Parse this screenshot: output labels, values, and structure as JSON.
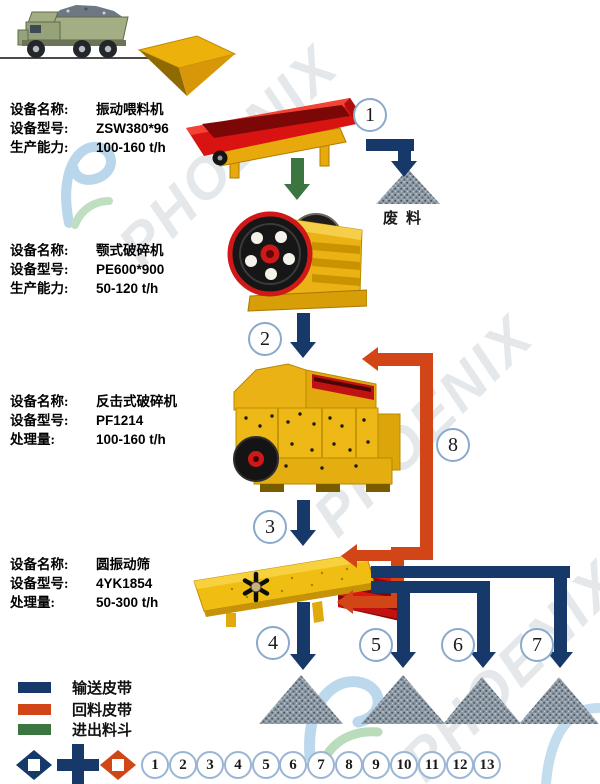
{
  "watermark": {
    "brand": "PHOENIX"
  },
  "colors": {
    "conveyor_navy": "#16396a",
    "return_red": "#d24517",
    "feed_green": "#3b7540",
    "machine_yellow": "#efb614",
    "badge_border": "#8aa9cc"
  },
  "equipment": [
    {
      "name_label": "设备名称:",
      "name": "振动喂料机",
      "model_label": "设备型号:",
      "model": "ZSW380*96",
      "capacity_label": "生产能力:",
      "capacity": "100-160 t/h"
    },
    {
      "name_label": "设备名称:",
      "name": "颚式破碎机",
      "model_label": "设备型号:",
      "model": "PE600*900",
      "capacity_label": "生产能力:",
      "capacity": "50-120 t/h"
    },
    {
      "name_label": "设备名称:",
      "name": "反击式破碎机",
      "model_label": "设备型号:",
      "model": "PF1214",
      "capacity_label": "处理量:",
      "capacity": "100-160 t/h"
    },
    {
      "name_label": "设备名称:",
      "name": "圆振动筛",
      "model_label": "设备型号:",
      "model": "4YK1854",
      "capacity_label": "处理量:",
      "capacity": "50-300 t/h"
    }
  ],
  "annotations": {
    "waste_pile": "废料"
  },
  "flow_steps": [
    "1",
    "2",
    "3",
    "4",
    "5",
    "6",
    "7",
    "8"
  ],
  "legend": {
    "items": [
      {
        "label": "输送皮带",
        "color": "#16396a"
      },
      {
        "label": "回料皮带",
        "color": "#d24517"
      },
      {
        "label": "进出料斗",
        "color": "#3b7540"
      }
    ]
  },
  "bottom_numbers": [
    "1",
    "2",
    "3",
    "4",
    "5",
    "6",
    "7",
    "8",
    "9",
    "10",
    "11",
    "12",
    "13"
  ]
}
